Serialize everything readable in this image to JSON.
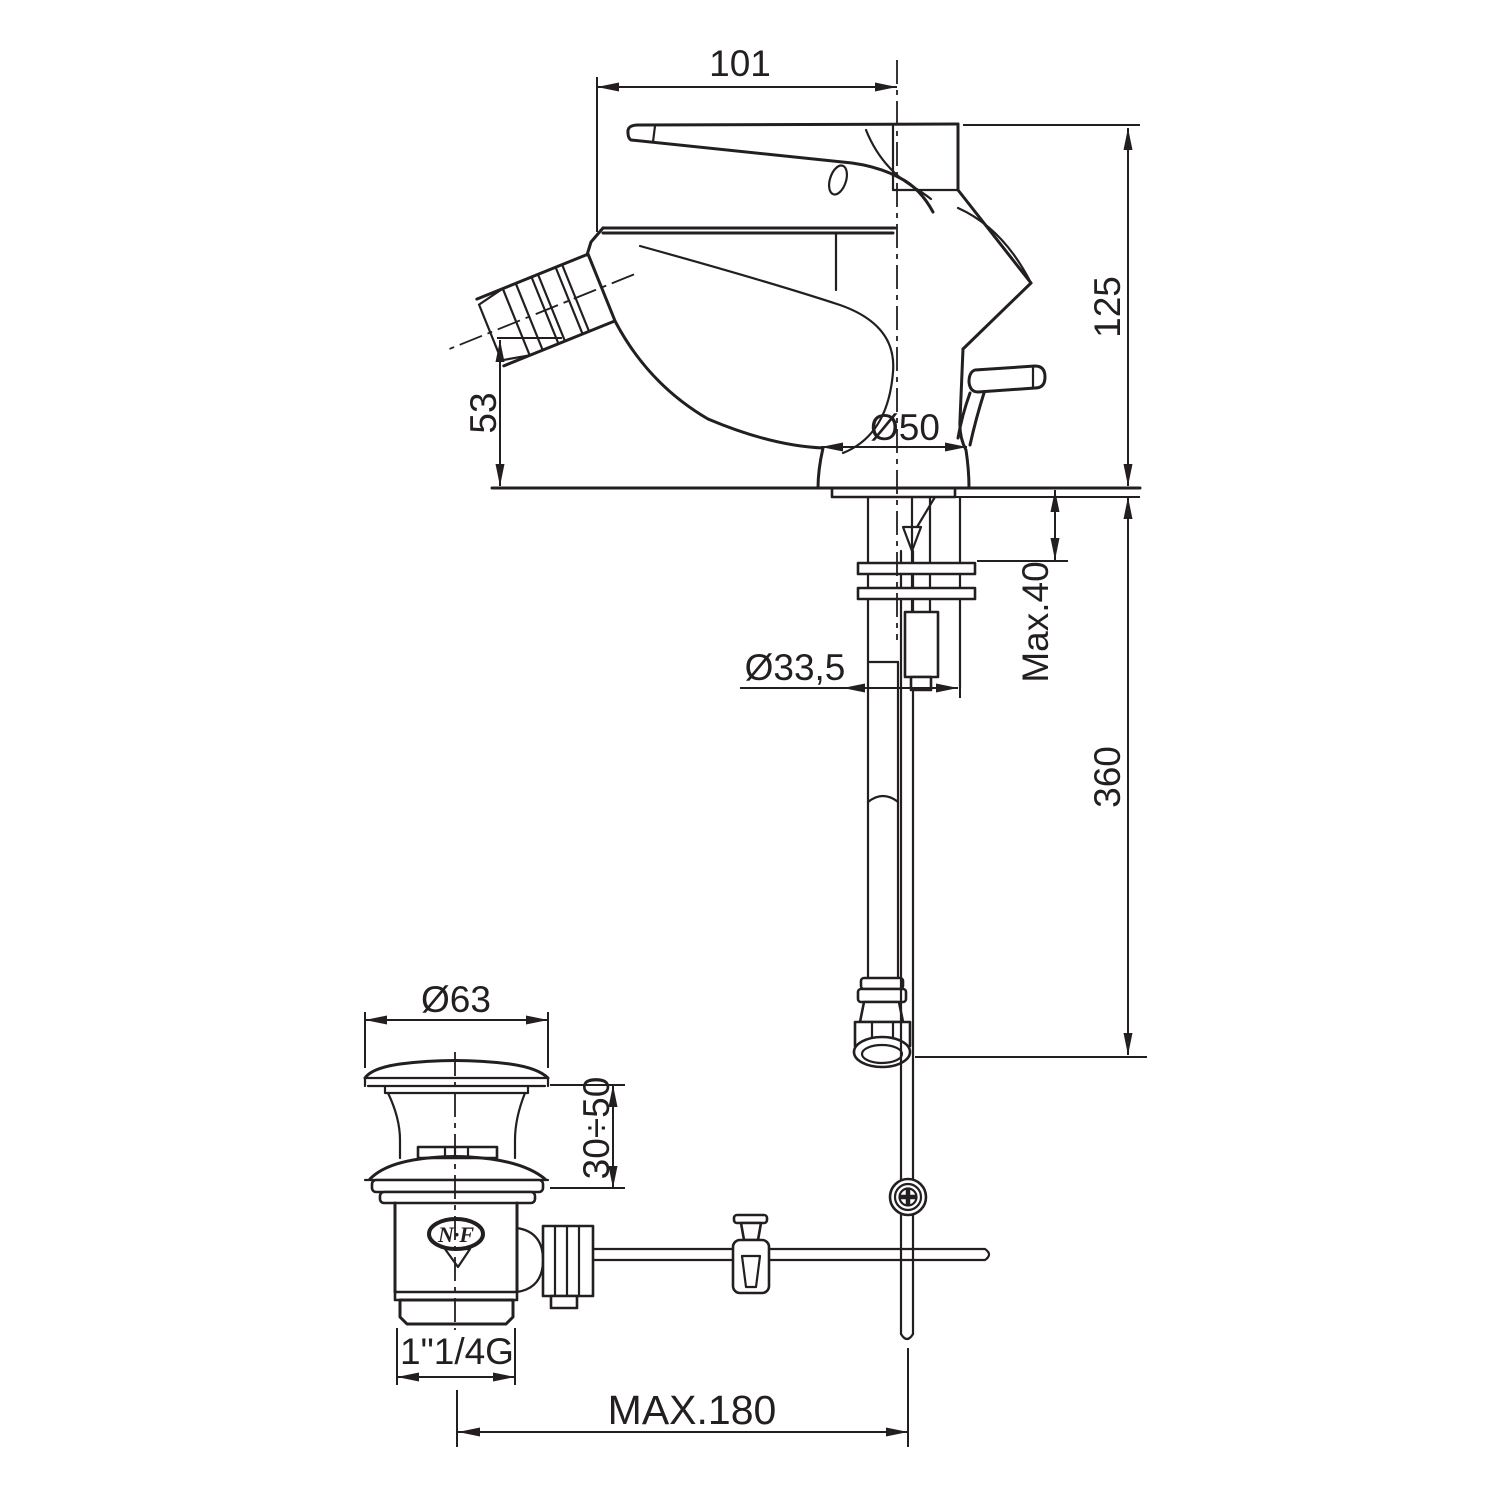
{
  "drawing": {
    "title": "bidet-mixer-with-pop-up-waste-technical-drawing",
    "colors": {
      "line": "#231f20",
      "background": "#ffffff"
    },
    "labels": {
      "top_width": "101",
      "height": "125",
      "spout_height": "53",
      "base_diameter": "Ø50",
      "max_deck": "Max.40",
      "shank_diameter": "Ø33,5",
      "hose_length": "360",
      "waste_diameter": "Ø63",
      "waste_height_range": "30÷50",
      "waste_thread": "1\"1/4G",
      "rod_max_reach": "MAX.180",
      "nf_mark": "N·F"
    }
  }
}
